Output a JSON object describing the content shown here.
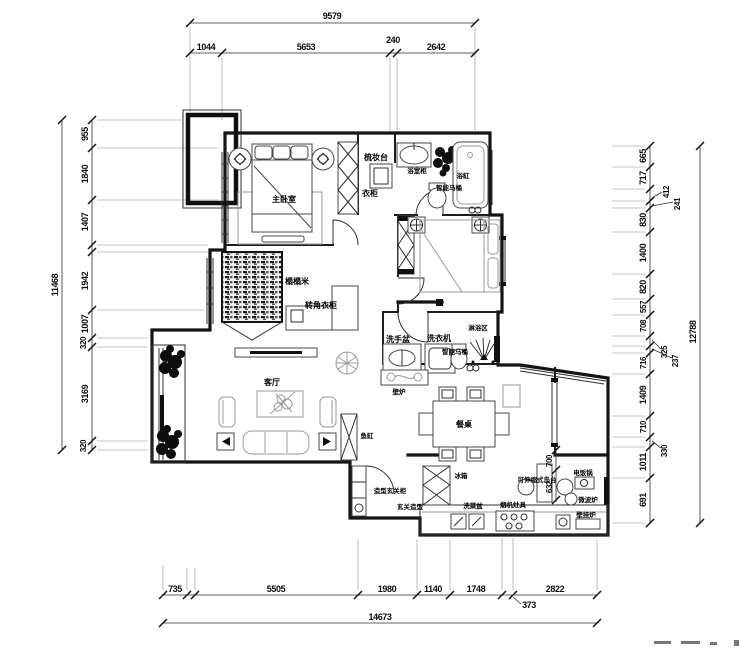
{
  "drawing": {
    "dims_mm": {
      "top": {
        "overall": "9579",
        "segments": [
          "1044",
          "5653",
          "240",
          "2642"
        ]
      },
      "bottom": {
        "overall": "14673",
        "segments": [
          "735",
          "5505",
          "1980",
          "1140",
          "1748",
          "373",
          "2822"
        ]
      },
      "left": {
        "overall": "11468",
        "segments": [
          "955",
          "1840",
          "1407",
          "1942",
          "1007",
          "320",
          "3169",
          "320"
        ]
      },
      "right": {
        "overall": "12788",
        "segments": [
          "665",
          "717",
          "412",
          "241",
          "830",
          "1400",
          "820",
          "557",
          "708",
          "325",
          "237",
          "716",
          "1409",
          "710",
          "330",
          "1011",
          "691"
        ]
      },
      "island": {
        "depth": "700",
        "width": "632"
      }
    },
    "labels": {
      "master_bedroom": "主卧室",
      "dressing_table": "梳妆台",
      "wardrobe": "衣柜",
      "bath_cabinet": "浴室柜",
      "bathtub": "浴缸",
      "smart_toilet": "智能马桶",
      "smart_toilet_2": "智能马桶",
      "tatami": "榻榻米",
      "corner_wardrobe": "转角衣柜",
      "living_room": "客厅",
      "fish_tank": "鱼缸",
      "hand_basin": "洗手盆",
      "washing_machine": "洗衣机",
      "shower_area": "淋浴区",
      "fireplace": "壁炉",
      "dining_table": "餐桌",
      "entry_cabinet": "造型玄关柜",
      "entry_feature": "玄关造型",
      "fridge": "冰箱",
      "veg_sink": "洗菜盆",
      "hood_stove": "烟机灶具",
      "island": "可伸缩式岛台",
      "rice_cooker": "电饭锅",
      "microwave": "微波炉",
      "wall_boiler": "壁挂炉"
    }
  }
}
